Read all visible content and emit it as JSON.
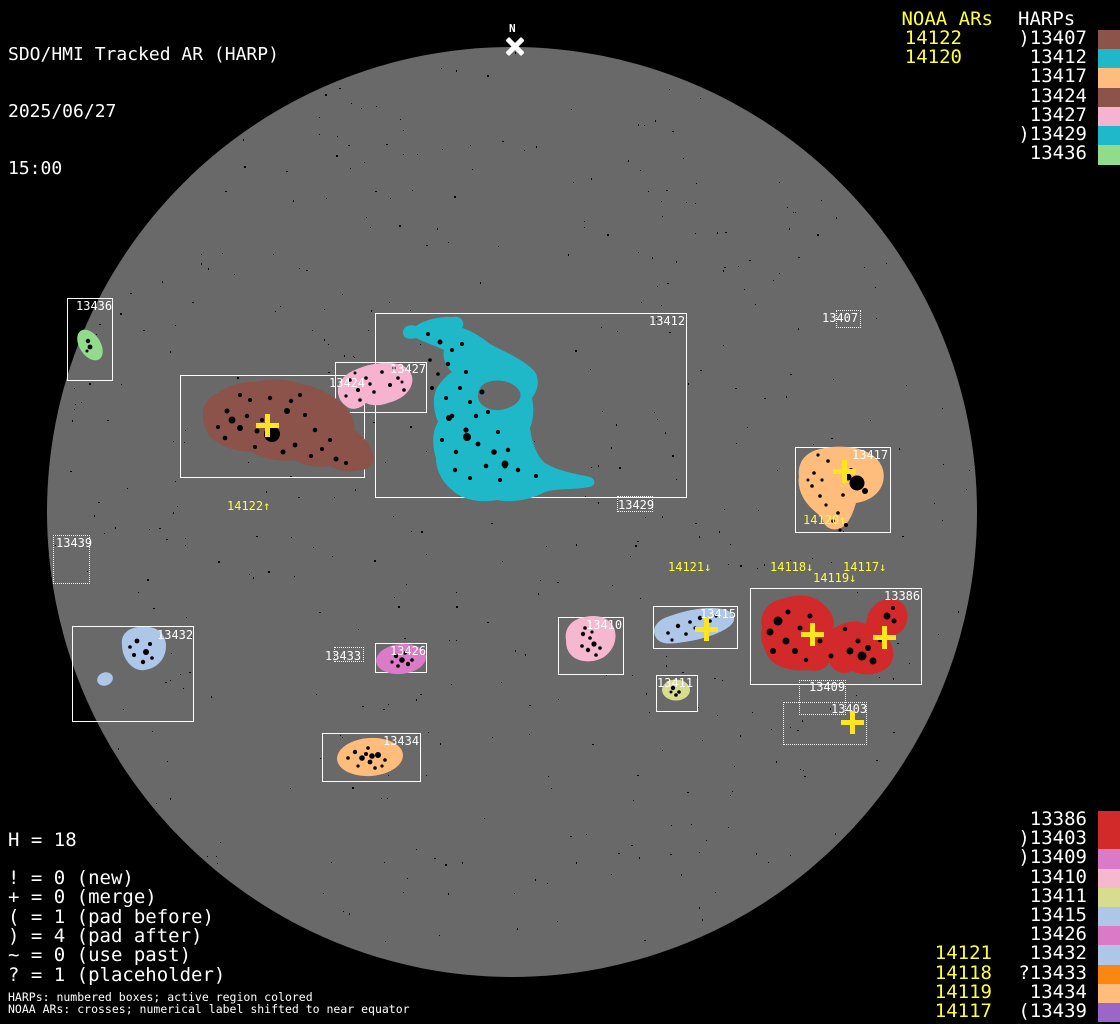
{
  "header": {
    "title": "SDO/HMI Tracked AR (HARP)",
    "date": "2025/06/27",
    "time": "15:00"
  },
  "north_marker": {
    "label": "N"
  },
  "colors": {
    "background": "#000000",
    "disk": "#696969",
    "box_border": "#FFFFFF",
    "label_text": "#FFFFFF",
    "noaa_text": "#FFFF3C",
    "cross": "#FFE51F"
  },
  "legend_top": {
    "noaa_title": "NOAA ARs",
    "harps_title": "HARPs",
    "noaa_items": [
      "14122",
      "14120"
    ],
    "harps": [
      {
        "prefix": ")",
        "number": "13407",
        "color": "#8B5349"
      },
      {
        "prefix": "",
        "number": "13412",
        "color": "#1EB8C9"
      },
      {
        "prefix": "",
        "number": "13417",
        "color": "#FFBD7D"
      },
      {
        "prefix": "",
        "number": "13424",
        "color": "#8B5349"
      },
      {
        "prefix": "",
        "number": "13427",
        "color": "#F5B3D0"
      },
      {
        "prefix": ")",
        "number": "13429",
        "color": "#1EB8C9"
      },
      {
        "prefix": "",
        "number": "13436",
        "color": "#90DC8B"
      }
    ]
  },
  "legend_bottom": {
    "rows": [
      {
        "noaa": "",
        "prefix": "",
        "number": "13386",
        "color": "#D2292A"
      },
      {
        "noaa": "",
        "prefix": ")",
        "number": "13403",
        "color": "#D2292A"
      },
      {
        "noaa": "",
        "prefix": ")",
        "number": "13409",
        "color": "#DB7BC7"
      },
      {
        "noaa": "",
        "prefix": "",
        "number": "13410",
        "color": "#F5B8CE"
      },
      {
        "noaa": "",
        "prefix": "",
        "number": "13411",
        "color": "#D8DC8F"
      },
      {
        "noaa": "",
        "prefix": "",
        "number": "13415",
        "color": "#AEC7E8"
      },
      {
        "noaa": "",
        "prefix": "",
        "number": "13426",
        "color": "#DB7BC7"
      },
      {
        "noaa": "14121",
        "prefix": "",
        "number": "13432",
        "color": "#AEC7E8"
      },
      {
        "noaa": "14118",
        "prefix": "?",
        "number": "13433",
        "color": "#FB8713"
      },
      {
        "noaa": "14119",
        "prefix": "",
        "number": "13434",
        "color": "#FFBD7D"
      },
      {
        "noaa": "14117",
        "prefix": "(",
        "number": "13439",
        "color": "#9A67C9"
      }
    ]
  },
  "stats": {
    "harp_count": "H = 18",
    "lines": [
      "! = 0 (new)",
      "+ = 0 (merge)",
      "( = 1 (pad before)",
      ") = 4 (pad after)",
      "~ = 0 (use past)",
      "? = 1 (placeholder)"
    ]
  },
  "footnotes": [
    "HARPs: numbered boxes; active region colored",
    "NOAA ARs: crosses; numerical label shifted to near equator"
  ],
  "regions": [
    {
      "id": "13436",
      "label": "13436",
      "style": "solid",
      "box": [
        67,
        298,
        46,
        83
      ],
      "label_pos": [
        76,
        300
      ],
      "color": "#90DC8B"
    },
    {
      "id": "13424",
      "label": "13424",
      "style": "solid",
      "box": [
        180,
        375,
        185,
        103
      ],
      "label_pos": [
        329,
        377
      ],
      "color": "#8B5349"
    },
    {
      "id": "13427",
      "label": "13427",
      "style": "solid",
      "box": [
        335,
        362,
        92,
        51
      ],
      "label_pos": [
        390,
        363
      ],
      "color": "#F5B3D0"
    },
    {
      "id": "13412",
      "label": "13412",
      "style": "solid",
      "box": [
        375,
        313,
        312,
        185
      ],
      "label_pos": [
        649,
        315
      ],
      "color": "#1EB8C9"
    },
    {
      "id": "13429",
      "label": "13429",
      "style": "dotted",
      "box": [
        617,
        496,
        36,
        16
      ],
      "label_pos": [
        618,
        499
      ],
      "color": "#1EB8C9"
    },
    {
      "id": "13407",
      "label": "13407",
      "style": "dotted",
      "box": [
        836,
        310,
        25,
        18
      ],
      "label_pos": [
        822,
        312
      ],
      "color": "#8B5349"
    },
    {
      "id": "13417",
      "label": "13417",
      "style": "solid",
      "box": [
        795,
        447,
        96,
        86
      ],
      "label_pos": [
        852,
        449
      ],
      "color": "#FFBD7D"
    },
    {
      "id": "13439",
      "label": "13439",
      "style": "dotted",
      "box": [
        53,
        535,
        37,
        49
      ],
      "label_pos": [
        56,
        537
      ],
      "color": "#9A67C9"
    },
    {
      "id": "13432",
      "label": "13432",
      "style": "solid",
      "box": [
        72,
        626,
        122,
        96
      ],
      "label_pos": [
        157,
        629
      ],
      "color": "#AEC7E8"
    },
    {
      "id": "13433",
      "label": "13433",
      "style": "dotted",
      "box": [
        334,
        647,
        30,
        15
      ],
      "label_pos": [
        325,
        650
      ],
      "color": "#FB8713"
    },
    {
      "id": "13426",
      "label": "13426",
      "style": "solid",
      "box": [
        375,
        643,
        52,
        30
      ],
      "label_pos": [
        390,
        645
      ],
      "color": "#DB7BC7"
    },
    {
      "id": "13410",
      "label": "13410",
      "style": "solid",
      "box": [
        558,
        617,
        66,
        58
      ],
      "label_pos": [
        586,
        619
      ],
      "color": "#F5B8CE"
    },
    {
      "id": "13415",
      "label": "13415",
      "style": "solid",
      "box": [
        653,
        606,
        85,
        43
      ],
      "label_pos": [
        700,
        608
      ],
      "color": "#AEC7E8"
    },
    {
      "id": "13411",
      "label": "13411",
      "style": "solid",
      "box": [
        656,
        675,
        42,
        37
      ],
      "label_pos": [
        657,
        677
      ],
      "color": "#D8DC8F"
    },
    {
      "id": "13386",
      "label": "13386",
      "style": "solid",
      "box": [
        750,
        588,
        172,
        97
      ],
      "label_pos": [
        884,
        590
      ],
      "color": "#D2292A"
    },
    {
      "id": "13409",
      "label": "13409",
      "style": "dotted",
      "box": [
        799,
        680,
        47,
        35
      ],
      "label_pos": [
        809,
        681
      ],
      "color": "#DB7BC7"
    },
    {
      "id": "13403",
      "label": "13403",
      "style": "dotted",
      "box": [
        783,
        702,
        84,
        43
      ],
      "label_pos": [
        831,
        703
      ],
      "color": "#D2292A"
    },
    {
      "id": "13434",
      "label": "13434",
      "style": "solid",
      "box": [
        322,
        733,
        99,
        49
      ],
      "label_pos": [
        383,
        735
      ],
      "color": "#FFBD7D"
    }
  ],
  "disk_noaa_labels": [
    {
      "text": "14122↑",
      "x": 227,
      "y": 500
    },
    {
      "text": "14120↑",
      "x": 803,
      "y": 514
    },
    {
      "text": "14121↓",
      "x": 668,
      "y": 561
    },
    {
      "text": "14118↓",
      "x": 770,
      "y": 561
    },
    {
      "text": "14119↓",
      "x": 813,
      "y": 572
    },
    {
      "text": "14117↓",
      "x": 843,
      "y": 561
    }
  ],
  "crosses": [
    {
      "x": 267,
      "y": 425
    },
    {
      "x": 844,
      "y": 471
    },
    {
      "x": 706,
      "y": 629
    },
    {
      "x": 812,
      "y": 634
    },
    {
      "x": 884,
      "y": 637
    },
    {
      "x": 852,
      "y": 722
    }
  ]
}
